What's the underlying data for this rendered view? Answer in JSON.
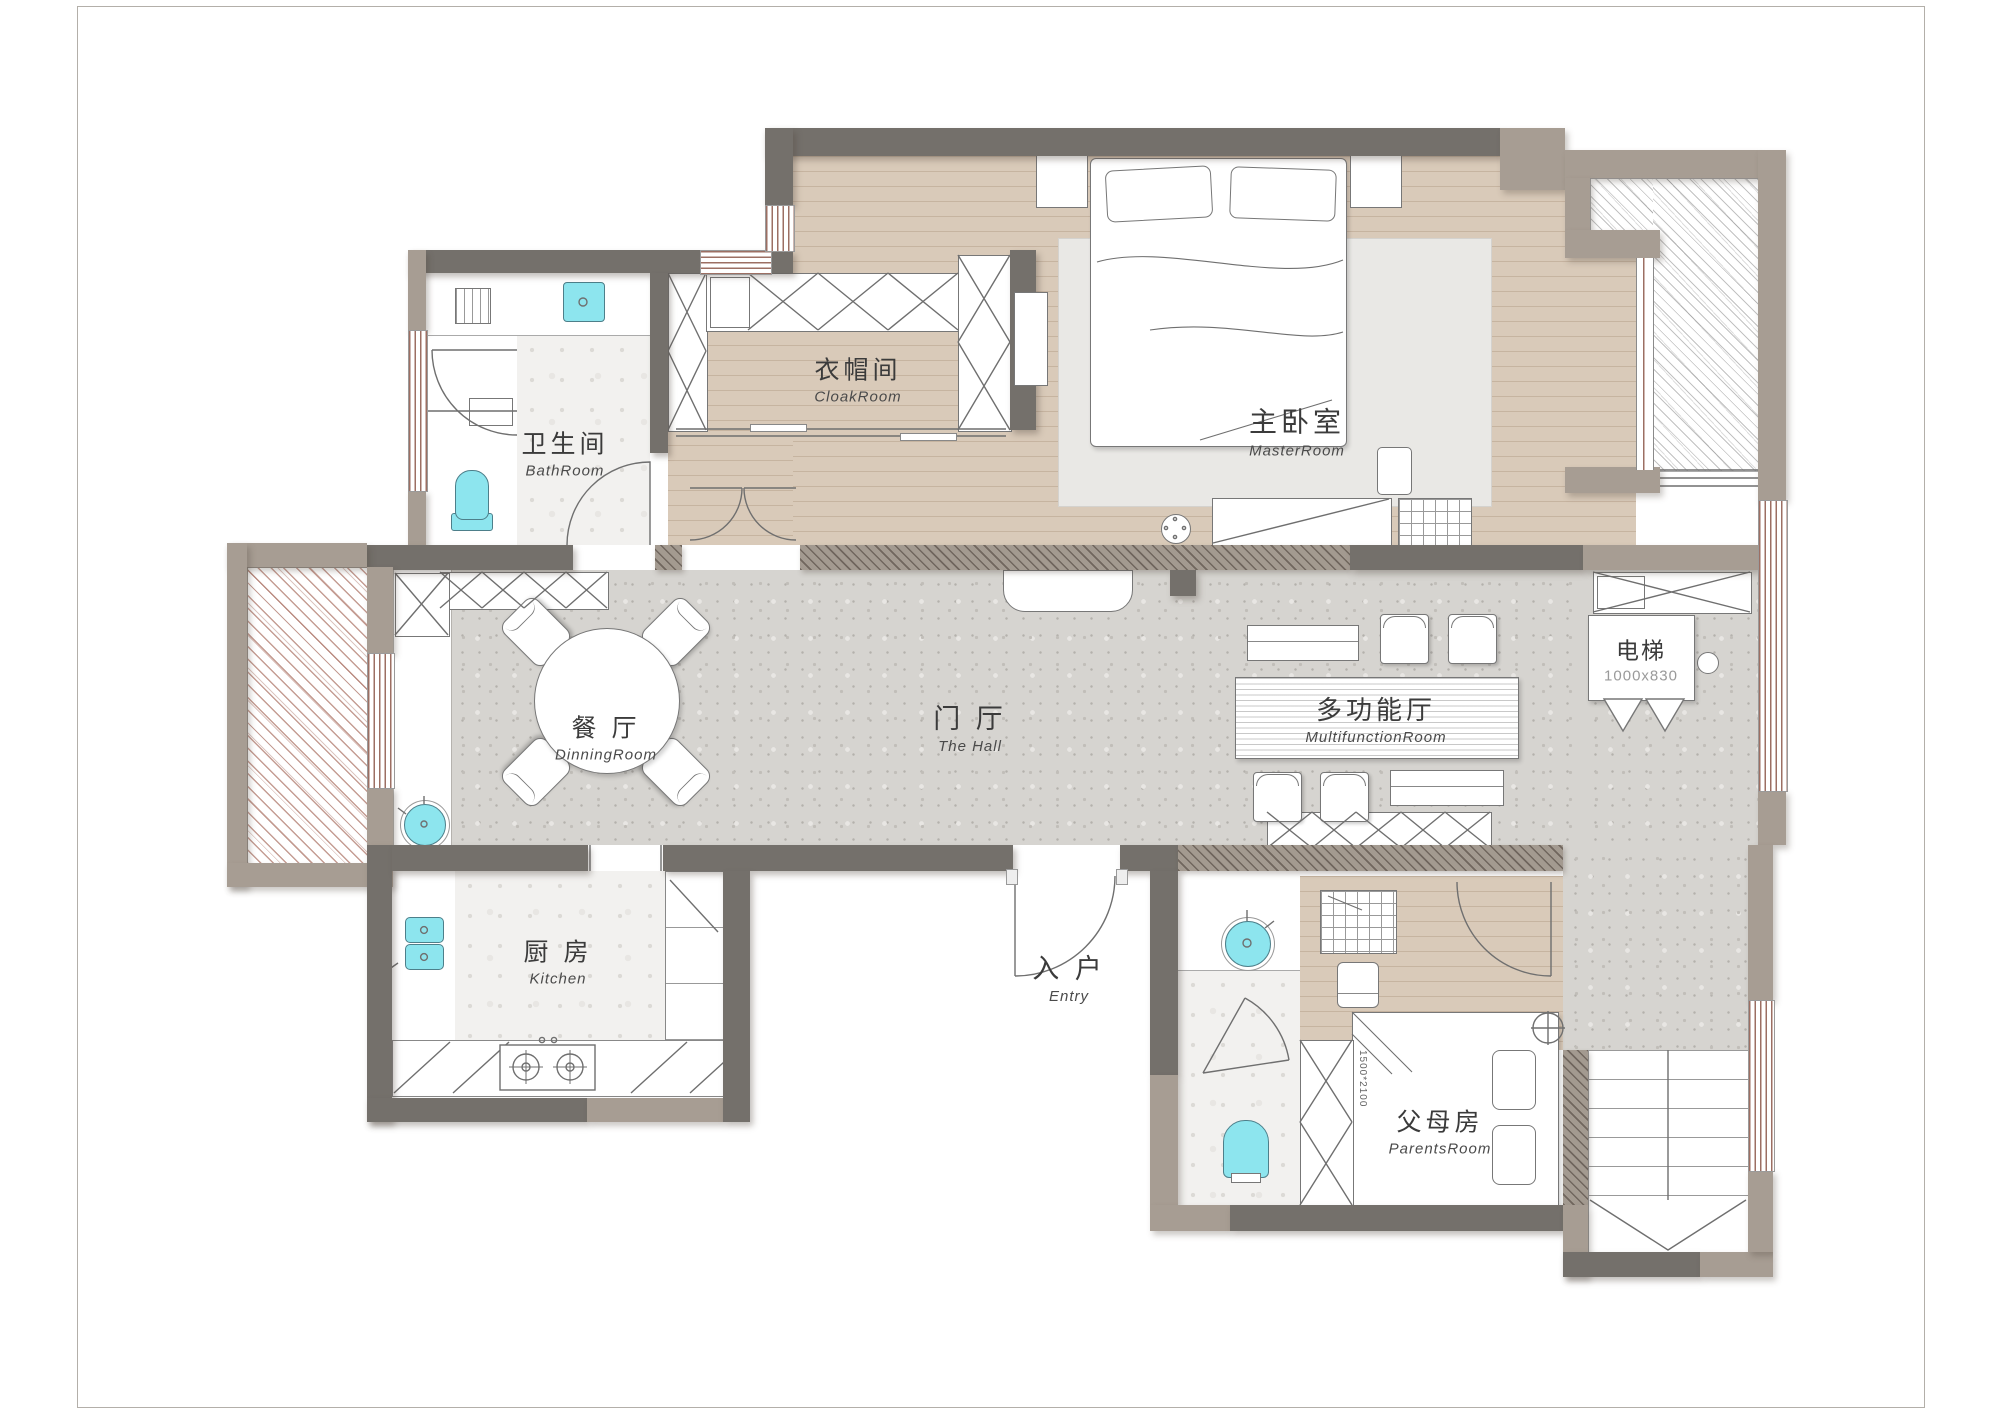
{
  "page": {
    "background": "#ffffff",
    "border_color": "#b3afa9"
  },
  "colors": {
    "wall_dark": "#74706b",
    "wall_taupe": "#a79d93",
    "floor_wood": "#d9cab9",
    "floor_hall_terrazzo": "#d6d4d0",
    "floor_wet_terrazzo": "#f2f1ef",
    "fixture_cyan": "#8de5ee",
    "balcony_hatch_red": "#9e5c4c",
    "rug": "#e9e8e5"
  },
  "rooms": [
    {
      "id": "bathroom",
      "zh": "卫生间",
      "en": "BathRoom"
    },
    {
      "id": "cloakroom",
      "zh": "衣帽间",
      "en": "CloakRoom"
    },
    {
      "id": "master",
      "zh": "主卧室",
      "en": "MasterRoom"
    },
    {
      "id": "dining",
      "zh": "餐 厅",
      "en": "DinningRoom"
    },
    {
      "id": "hall",
      "zh": "门 厅",
      "en": "The Hall"
    },
    {
      "id": "multifunction",
      "zh": "多功能厅",
      "en": "MultifunctionRoom"
    },
    {
      "id": "elevator",
      "zh": "电梯",
      "en": "1000x830"
    },
    {
      "id": "kitchen",
      "zh": "厨 房",
      "en": "Kitchen"
    },
    {
      "id": "entry",
      "zh": "入 户",
      "en": "Entry"
    },
    {
      "id": "parents",
      "zh": "父母房",
      "en": "ParentsRoom"
    }
  ],
  "annotations": {
    "parents_bed_dim": "1500*2100"
  }
}
